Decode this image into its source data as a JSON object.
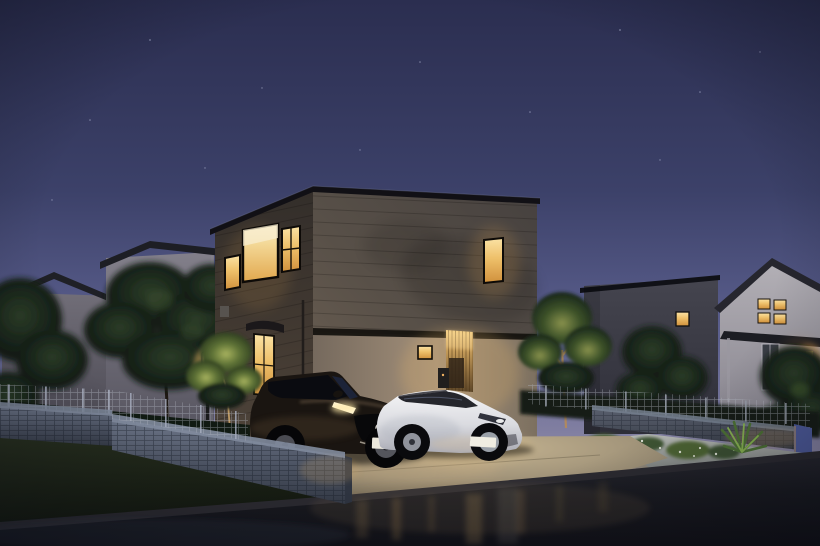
{
  "scene": {
    "description": "Photorealistic dusk rendering of a modern two-story flat-roof house on a suburban corner lot, wood-slat entry lit warmly, dark compact SUV and white hatchback parked on the driveway, wet asphalt road in the foreground reflecting warm light, neighboring gabled houses and landscaped gravel beds with uplit trees",
    "time_of_day": "dusk",
    "weather": "clear sky, damp road surface"
  },
  "palette": {
    "sky_top": "#2b2e50",
    "sky_mid": "#5d6190",
    "sky_horizon": "#a89fb2",
    "facade_upper": "#5d564f",
    "facade_west": "#3c362f",
    "facade_ground": "#a3907a",
    "window_glow": "#eec06a",
    "wood_entry": "#caa05c",
    "roof_fascia": "#111015",
    "lawn": "#1d2517",
    "driveway": "#b5a488",
    "road": "#17181e",
    "block_wall": "#5a6374",
    "mesh_fence": "#b8bdc8",
    "foliage_dark": "#18241a",
    "foliage_uplit": "#88914c",
    "suv_body": "#1a1511",
    "white_car_body": "#e9e9ee",
    "porch_light": "#ffd27e"
  },
  "objects": {
    "main_house": {
      "style": "modern two-story flat-roof box, dark horizontal siding, lighter ground floor",
      "floors": 2,
      "lit_windows": 7,
      "features": [
        "corner picture window",
        "vertical wood-slat entry with downlight",
        "curved awning over side window",
        "downpipe",
        "small square window",
        "utility box"
      ]
    },
    "vehicles": [
      {
        "kind": "dark compact SUV with lit grille emblem and headlights",
        "license_plate": ""
      },
      {
        "kind": "white aerodynamic hatchback",
        "license_plate": ""
      }
    ],
    "neighbor_houses": [
      {
        "position": "far left",
        "style": "grey gabled house",
        "lit_windows": 1
      },
      {
        "position": "left",
        "style": "grey gabled house",
        "lit_windows": 1
      },
      {
        "position": "right",
        "style": "dark grey flat-roof house",
        "lit_windows": 1
      },
      {
        "position": "far right",
        "style": "white gabled house with porch",
        "lit_windows": 4,
        "features": [
          "porch lamp",
          "glass entry door"
        ]
      }
    ],
    "landscape": [
      "dark lawn on corner lot",
      "concrete block retaining walls",
      "mesh fences on walls",
      "white gravel planting bed with flowers",
      "yucca plant",
      "uplit garden trees",
      "garden lamp post"
    ],
    "road": "wet asphalt with warm vertical light reflections"
  }
}
